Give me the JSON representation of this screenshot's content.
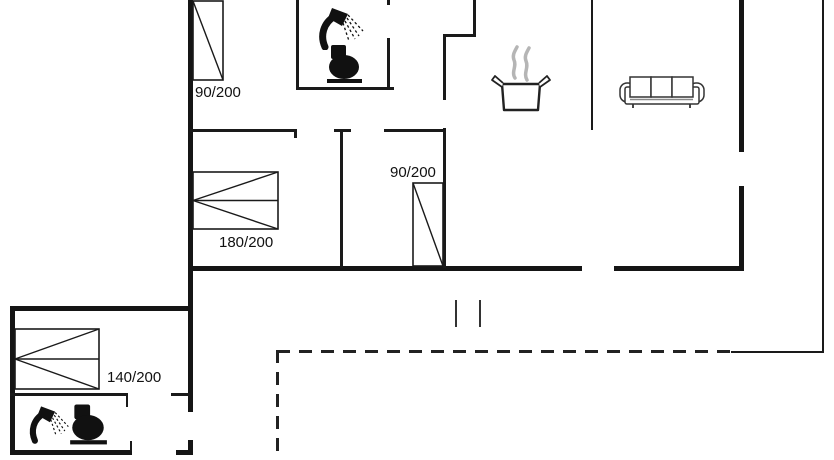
{
  "plan": {
    "type": "summerhouse-floor-plan",
    "line_color": "#1a1a1a",
    "steam_color": "#b5b5b5",
    "beds": {
      "top_left": {
        "label": "90/200"
      },
      "master": {
        "label": "180/200"
      },
      "second": {
        "label": "90/200"
      },
      "annex": {
        "label": "140/200"
      }
    },
    "icons": [
      "shower-icon",
      "toilet-icon",
      "cooking-pot-icon",
      "sofa-icon"
    ]
  }
}
